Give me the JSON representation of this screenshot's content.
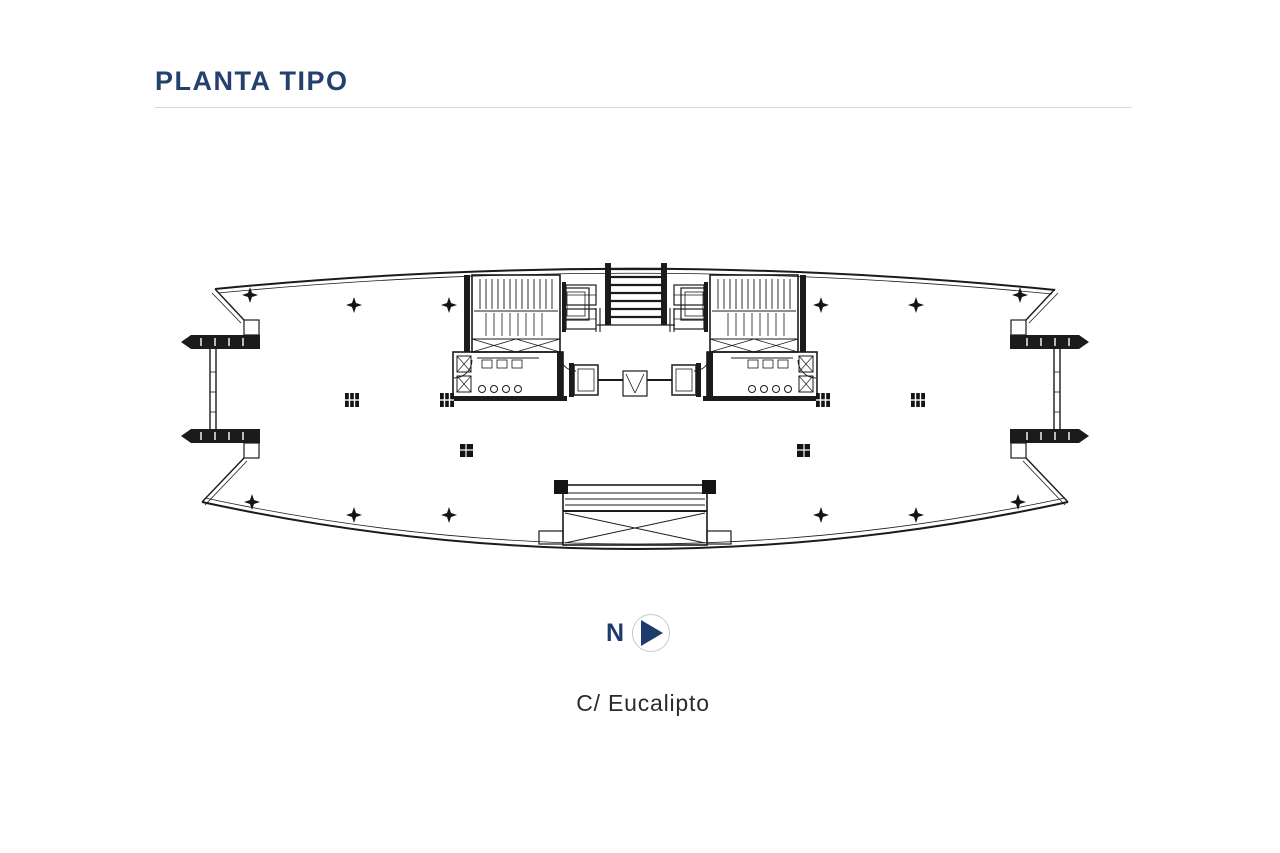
{
  "header": {
    "title": "PLANTA TIPO",
    "title_color": "#24406e"
  },
  "compass": {
    "label": "N",
    "arrow_color": "#1f3b6e",
    "ring_color": "#c9c9c9",
    "direction": "right"
  },
  "street": {
    "label": "C/ Eucalipto"
  },
  "plan": {
    "ink_color": "#1b1b1b",
    "background": "#ffffff",
    "column_star_count": 12,
    "column_grid_count": 4,
    "cores": 2
  }
}
